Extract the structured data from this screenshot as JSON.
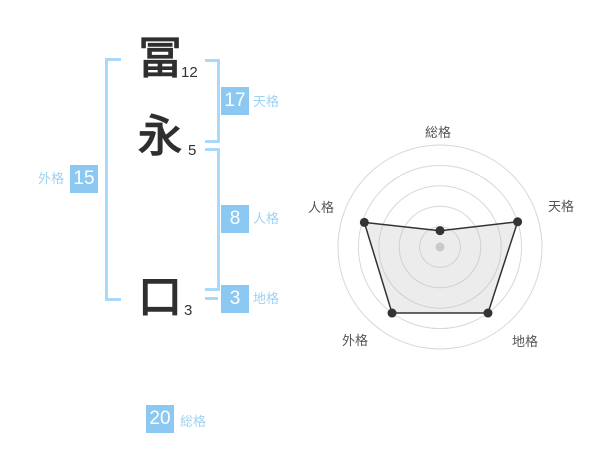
{
  "colors": {
    "badge_blue": "#8CC9F2",
    "label_blue": "#A0D2F2",
    "bracket_blue": "#A9D9F8",
    "chart_grid": "#D8D8D8",
    "chart_line": "#333333",
    "chart_fill": "rgba(185,185,185,0.28)",
    "chart_label": "#555555",
    "chart_center_dot": "#C9C9C9",
    "text_dark": "#333333"
  },
  "name_panel": {
    "characters": [
      {
        "char": "冨",
        "strokes": "12"
      },
      {
        "char": "永",
        "strokes": "5"
      },
      {
        "char": "口",
        "strokes": "3"
      }
    ],
    "badges": {
      "tenkaku": {
        "value": "17",
        "label": "天格"
      },
      "jinkaku": {
        "value": "8",
        "label": "人格"
      },
      "chikaku": {
        "value": "3",
        "label": "地格"
      },
      "gaikaku": {
        "value": "15",
        "label": "外格"
      },
      "soukaku": {
        "value": "20",
        "label": "総格"
      }
    }
  },
  "chart_data": {
    "type": "radar",
    "axes": [
      "総格",
      "天格",
      "地格",
      "外格",
      "人格"
    ],
    "values": [
      0.8,
      4,
      4,
      4,
      3.9
    ],
    "max": 5,
    "rings": 5,
    "grid": "concentric-circles",
    "legend": false,
    "axis_scores_shown_as_badges": {
      "総格": 20,
      "天格": 17,
      "人格": 8,
      "地格": 3,
      "外格": 15
    }
  }
}
